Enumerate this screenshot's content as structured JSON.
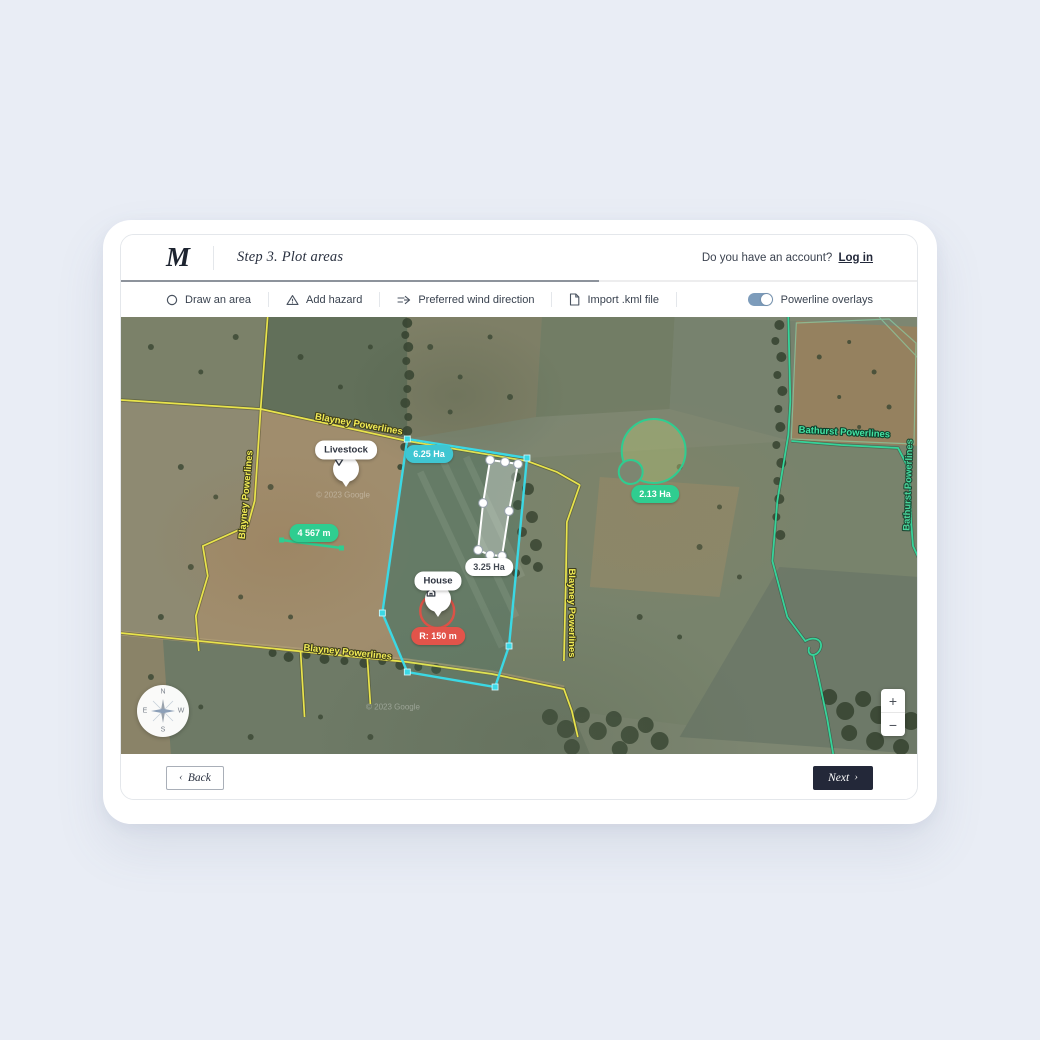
{
  "header": {
    "logo": "M",
    "title": "Step 3. Plot areas",
    "account_prompt": "Do you have an account?",
    "login_link": "Log in",
    "progress_percent": 60
  },
  "toolbar": {
    "items": [
      {
        "label": "Draw an area",
        "icon": "circle-icon"
      },
      {
        "label": "Add hazard",
        "icon": "warning-triangle-icon"
      },
      {
        "label": "Preferred wind direction",
        "icon": "wind-direction-icon"
      },
      {
        "label": "Import .kml file",
        "icon": "file-icon"
      }
    ],
    "powerline_toggle": {
      "label": "Powerline overlays",
      "state": "on"
    }
  },
  "map": {
    "watermark": "© 2023 Google",
    "powerlines": {
      "blayney_label": "Blayney Powerlines",
      "bathurst_label": "Bathurst Powerlines"
    },
    "areas": {
      "drawn_area": "6.25 Ha",
      "inner_area": "3.25 Ha",
      "circle_area": "2.13 Ha",
      "distance": "4 567 m"
    },
    "markers": {
      "livestock": "Livestock",
      "house": "House",
      "house_radius": "R: 150 m"
    },
    "compass": {
      "n": "N",
      "e": "E",
      "s": "S",
      "w": "W"
    },
    "zoom_control": {
      "zoom_in": "+",
      "zoom_out": "−"
    },
    "colors": {
      "cyan": "#3bd8e4",
      "teal_badge": "#3fc6d2",
      "green": "#2fcd90",
      "red": "#e2544a",
      "yellow": "#e9e44b"
    }
  },
  "footer": {
    "back_chevron": "‹",
    "back_label": "Back",
    "next_label": "Next",
    "next_chevron": "›"
  }
}
